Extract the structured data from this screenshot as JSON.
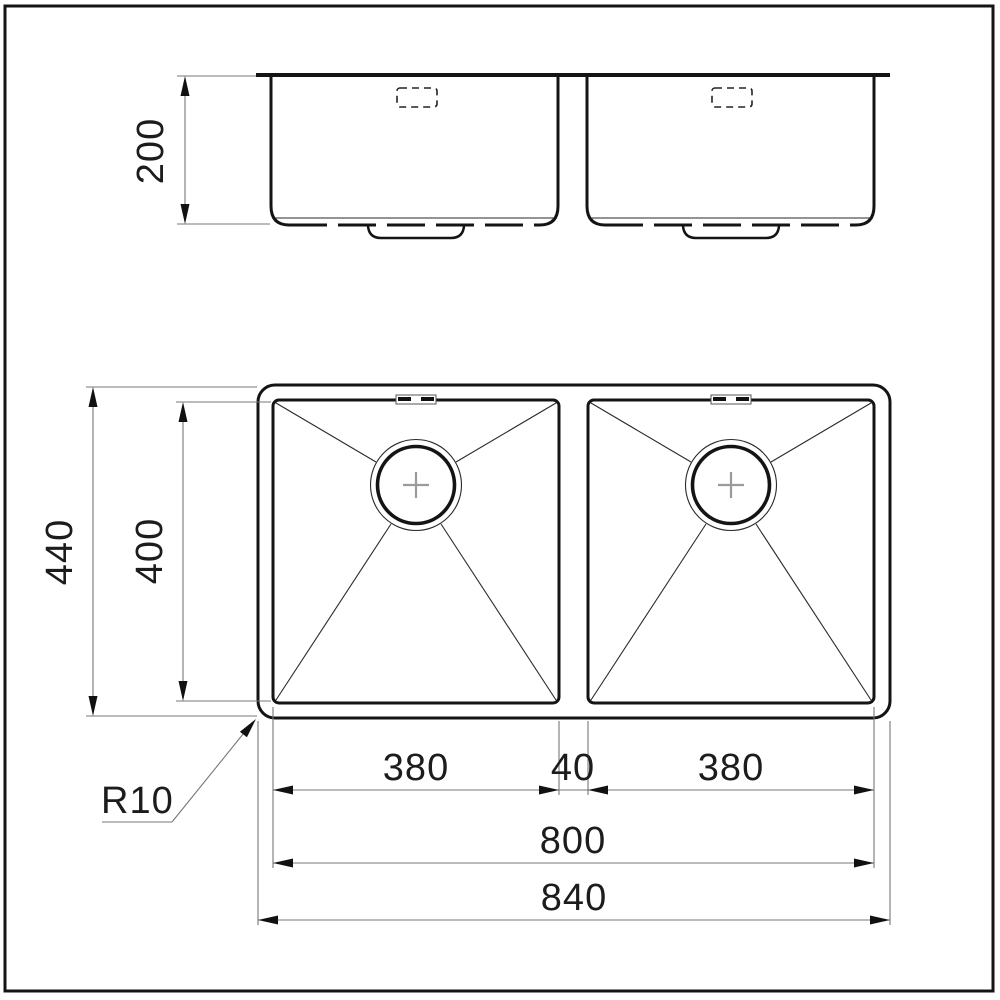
{
  "drawing": {
    "type": "technical-dimension-drawing",
    "subject": "double-bowl undermount sink, front elevation and plan view",
    "dimensions": {
      "depth": "200",
      "plan_overall_width": "440",
      "plan_bowl_width": "400",
      "bowl_left_length": "380",
      "divider_width": "40",
      "bowl_right_length": "380",
      "inner_length": "800",
      "overall_length": "840",
      "corner_radius": "R10"
    },
    "colors": {
      "background": "#ffffff",
      "outline": "#141414",
      "dimension_line": "#777777",
      "arrowhead": "#111111",
      "drain_cross": "#9a9a9a"
    },
    "icons": {
      "drain_symbol": "circle-with-cross",
      "overflow_symbol": "dashed-rectangle"
    }
  }
}
